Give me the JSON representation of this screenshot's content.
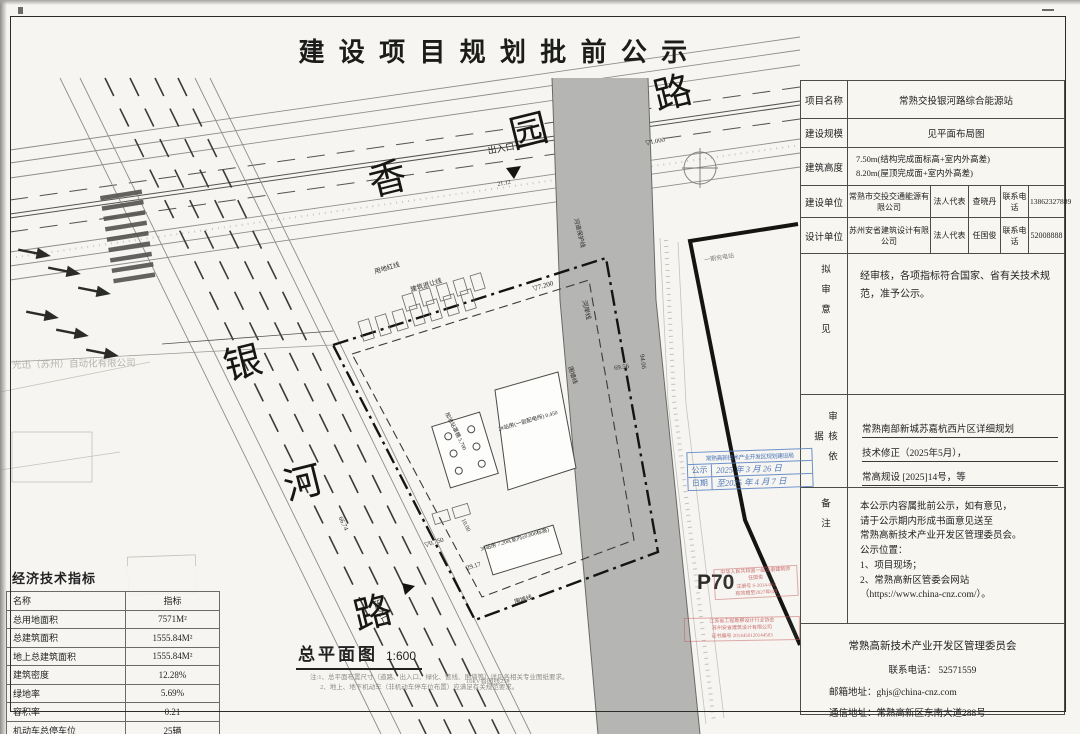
{
  "title": "建设项目规划批前公示",
  "info": {
    "project_name_label": "项目名称",
    "project_name": "常熟交投银河路综合能源站",
    "scale_label": "建设规模",
    "scale_value": "见平面布局图",
    "height_label": "建筑高度",
    "height_line1": "7.50m(结构完成面标高+室内外高差)",
    "height_line2": "8.20m(屋顶完成面+室内外高差)",
    "builder_label": "建设单位",
    "builder_name": "常熟市交投交通能源有限公司",
    "rep_label": "法人代表",
    "builder_rep": "查晓丹",
    "tel_label": "联系电话",
    "builder_tel": "13862327889",
    "designer_label": "设计单位",
    "designer_name": "苏州安省建筑设计有限公司",
    "designer_rep": "任国俊",
    "designer_tel": "52008888",
    "opinion_label": "拟审意见",
    "opinion_text": "经审核，各项指标符合国家、省有关技术规范，准予公示。",
    "basis_label": "审核依据",
    "basis_lines": [
      "常熟南部新城苏嘉杭西片区详细规划",
      "技术修正（2025年5月），",
      "常高规设 [2025]14号，等"
    ],
    "remark_label": "备注",
    "remark_lines": [
      "本公示内容属批前公示，如有意见，",
      "请于公示期内形成书面意见送至",
      "常熟高新技术产业开发区管理委员会。",
      "公示位置：",
      "1、项目现场；",
      "2、常熟高新区管委会网站",
      "（https://www.china-cnz.com/）。"
    ],
    "footer_org": "常熟高新技术产业开发区管理委员会",
    "footer_tel": "联系电话：    52571559",
    "footer_email": "邮箱地址：ghjs@china-cnz.com",
    "footer_address": "通信地址：常熟高新区东南大道288号"
  },
  "econ": {
    "title": "经济技术指标",
    "col_name": "名称",
    "col_value": "指标",
    "rows": [
      [
        "总用地面积",
        "7571M²"
      ],
      [
        "总建筑面积",
        "1555.84M²"
      ],
      [
        "地上总建筑面积",
        "1555.84M²"
      ],
      [
        "建筑密度",
        "12.28%"
      ],
      [
        "绿地率",
        "5.69%"
      ],
      [
        "容积率",
        "0.21"
      ],
      [
        "机动车总停车位",
        "25辆"
      ]
    ]
  },
  "map": {
    "caption": "总平面图",
    "caption_scale": "1:600",
    "notes": [
      "注:1、总平面布置尺寸（道路、出入口、绿化、管线、围墙等）详见各相关专业图纸要求。",
      "2、地上、地下机动车（非机动车停车位布置）应满足有关规范要求。"
    ],
    "labels": [
      {
        "t": "香"
      },
      {
        "t": "园"
      },
      {
        "t": "路"
      },
      {
        "t": "银"
      },
      {
        "t": "河"
      },
      {
        "t": "路"
      },
      {
        "t": "出入口"
      },
      {
        "t": "21.12"
      },
      {
        "t": "出入口"
      },
      {
        "t": "用地红线"
      },
      {
        "t": "建筑退让线"
      },
      {
        "t": "河道保护线"
      },
      {
        "t": "河岸线"
      },
      {
        "t": "围墙线"
      },
      {
        "t": "69.56"
      },
      {
        "t": "94.06"
      },
      {
        "t": "66.74"
      },
      {
        "t": "29.17"
      },
      {
        "t": "10.00"
      },
      {
        "t": "▽7.200"
      },
      {
        "t": "▽1.000"
      },
      {
        "t": "▽0.750"
      },
      {
        "t": "加油站罩棚 5.700"
      },
      {
        "t": "2#站房(一层配电所) 0.450"
      },
      {
        "t": "3#站房 7.200(室内±0.000标高)"
      },
      {
        "t": "围墙线"
      },
      {
        "t": "10kV香园线25#"
      },
      {
        "t": "光迅（苏州）自动化有限公司"
      },
      {
        "t": "一期充电站"
      },
      {
        "t": "P70"
      }
    ],
    "blue_stamp": {
      "header": "常熟高新技术产业开发区规划建设局",
      "row1_label": "公示",
      "row1_value": "2025 年 3 月 26 日",
      "row2_label": "日期",
      "row2_value": "至2025 年 4 月 7 日"
    },
    "red_stamp1_lines": [
      "中华人民共和国一级注册建筑师",
      "任国俊",
      "注册号 S-2014-063",
      "有效期至2027年6月"
    ],
    "red_stamp2_lines": [
      "江苏省工程勘察设计行业协会",
      "苏州安省建筑设计有限公司",
      "证书编号 2014450120144503"
    ]
  }
}
